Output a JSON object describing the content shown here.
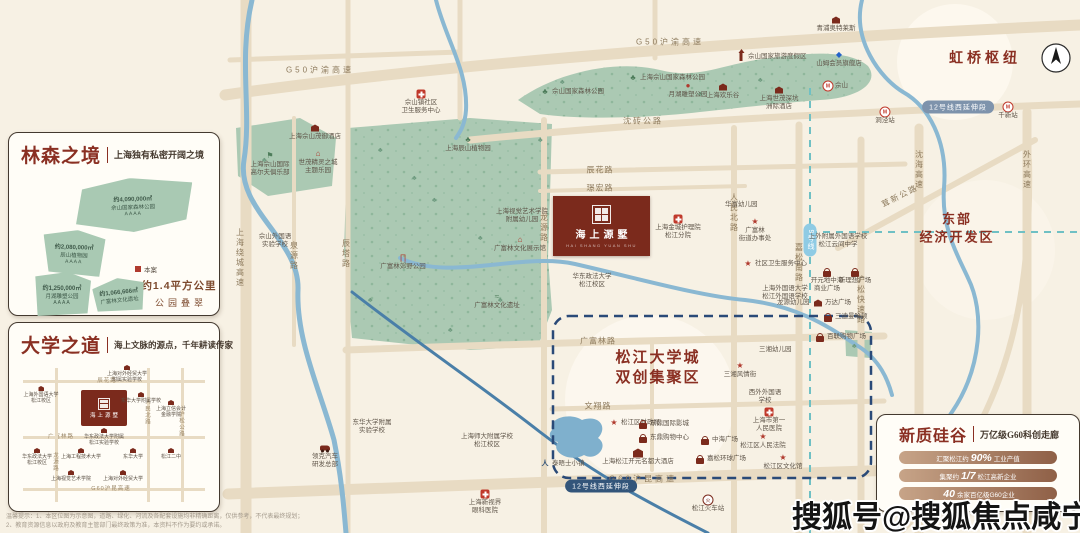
{
  "watermark": "搜狐号@搜狐焦点咸宁站",
  "disclaimer": {
    "line1": "温馨提示：1、本区位图为示意图，道路、绿化、河流及各配套设施均非精确距离，仅供参考，不代表最终规划；",
    "line2": "2、教育资源信息以政府及教育主管部门最终政策为准，本资料不作为要约或承诺。"
  },
  "project": {
    "name": "海上源墅",
    "name_en": "HAI SHANG YUAN SHU"
  },
  "colors": {
    "accent": "#8a2f22",
    "park_green": "#abc9b3",
    "river_blue": "#8ab8d2",
    "road_tan": "#e8dbc3",
    "navy_dash": "#2a4a78",
    "teal_dash": "#6fc0c4"
  },
  "cards": {
    "forest": {
      "title": "林森之境",
      "subtitle": "上海独有私密开阔之境",
      "patches": [
        {
          "x": 56,
          "y": 6,
          "w": 120,
          "h": 54,
          "rot": -2,
          "shape": 1,
          "lines": [
            "约4,090,000㎡",
            "佘山国家森林公园",
            "AAAA"
          ]
        },
        {
          "x": 26,
          "y": 58,
          "w": 62,
          "h": 46,
          "rot": 2,
          "shape": 2,
          "lines": [
            "约2,080,000㎡",
            "辰山植物园",
            "AAAA"
          ]
        },
        {
          "x": 16,
          "y": 100,
          "w": 58,
          "h": 44,
          "rot": 0,
          "shape": 3,
          "lines": [
            "约1,250,000㎡",
            "月湖雕塑公园",
            "AAAA"
          ]
        },
        {
          "x": 76,
          "y": 106,
          "w": 52,
          "h": 34,
          "rot": -6,
          "shape": 4,
          "lines": [
            "约1,066,666㎡",
            "广富林文化遗址"
          ]
        }
      ],
      "legend": "本案",
      "highlight": {
        "line1": "约1.4平方公里",
        "line2": "公园叠翠"
      }
    },
    "university": {
      "title": "大学之道",
      "subtitle": "海上文脉的源点，千年耕读传家",
      "minimap": {
        "roads": [
          {
            "o": "h",
            "pos": 16,
            "label": "辰花路",
            "lx": 88,
            "ly": 16
          },
          {
            "o": "h",
            "pos": 72,
            "label": "广富林路",
            "lx": 42,
            "ly": 72
          },
          {
            "o": "h",
            "pos": 124,
            "label": "G60沪昆高速",
            "lx": 92,
            "ly": 124
          },
          {
            "o": "v",
            "pos": 36,
            "label": "龙源路",
            "lx": 36,
            "ly": 98
          },
          {
            "o": "v",
            "pos": 128,
            "label": "人民北路",
            "lx": 128,
            "ly": 48
          },
          {
            "o": "v",
            "pos": 162,
            "label": "沪松公路",
            "lx": 162,
            "ly": 60
          }
        ],
        "logo_name": "海上源墅",
        "schools": [
          {
            "x": 22,
            "y": 22,
            "t": "上海外国语大学\n松江校区"
          },
          {
            "x": 108,
            "y": 1,
            "t": "上海对外经贸大学\n附属实验学校"
          },
          {
            "x": 122,
            "y": 28,
            "t": "东华大学附属学校"
          },
          {
            "x": 152,
            "y": 36,
            "t": "上海立信会计\n金融学院"
          },
          {
            "x": 152,
            "y": 84,
            "t": "松江二中"
          },
          {
            "x": 85,
            "y": 64,
            "t": "华东政法大学附属\n松江实验学校"
          },
          {
            "x": 18,
            "y": 84,
            "t": "华东政法大学\n松江校区"
          },
          {
            "x": 62,
            "y": 84,
            "t": "上海工程技术大学"
          },
          {
            "x": 114,
            "y": 84,
            "t": "东华大学"
          },
          {
            "x": 52,
            "y": 106,
            "t": "上海视觉艺术学院"
          },
          {
            "x": 104,
            "y": 106,
            "t": "上海对外经贸大学"
          }
        ]
      }
    },
    "silicon": {
      "title": "新质硅谷",
      "subtitle": "万亿级G60科创走廊",
      "bars": [
        {
          "pre": "汇聚松江约",
          "big": "90%",
          "suf": "工业产值"
        },
        {
          "pre": "集聚约",
          "big": "1/7",
          "suf": "松江高新企业"
        },
        {
          "pre": "",
          "big": "40",
          "suf": "余家百亿级G60企业"
        }
      ]
    }
  },
  "map": {
    "area_labels": [
      {
        "text": "虹桥枢纽",
        "x": 985,
        "y": 60,
        "size": 14,
        "ls": 4
      },
      {
        "text": "东部\n经济开发区",
        "x": 957,
        "y": 228,
        "size": 13,
        "ls": 2
      },
      {
        "text": "松江大学城\n双创集聚区",
        "x": 658,
        "y": 368,
        "size": 15,
        "ls": 2
      }
    ],
    "road_labels": [
      {
        "t": "G50沪渝高速",
        "x": 320,
        "y": 70,
        "ls": 3
      },
      {
        "t": "G50沪渝高速",
        "x": 670,
        "y": 42,
        "ls": 3
      },
      {
        "t": "沈砖公路",
        "x": 643,
        "y": 121,
        "ls": 2
      },
      {
        "t": "辰花路",
        "x": 600,
        "y": 170,
        "ls": 1
      },
      {
        "t": "璟宏路",
        "x": 600,
        "y": 188,
        "ls": 1
      },
      {
        "t": "广富林路",
        "x": 598,
        "y": 341,
        "ls": 1
      },
      {
        "t": "文翔路",
        "x": 598,
        "y": 406,
        "ls": 1
      },
      {
        "t": "G60沪昆高速",
        "x": 643,
        "y": 479,
        "ls": 3
      },
      {
        "t": "上海绕城高速",
        "x": 240,
        "y": 258,
        "v": 1
      },
      {
        "t": "泉源路",
        "x": 294,
        "y": 256,
        "v": 1
      },
      {
        "t": "辰塔路",
        "x": 346,
        "y": 254,
        "v": 1
      },
      {
        "t": "龙源路",
        "x": 544,
        "y": 228,
        "v": 1
      },
      {
        "t": "人民北路",
        "x": 734,
        "y": 213,
        "v": 1
      },
      {
        "t": "嘉松南路",
        "x": 799,
        "y": 263,
        "v": 1
      },
      {
        "t": "沪松快速路",
        "x": 861,
        "y": 300,
        "v": 1
      },
      {
        "t": "茸新公路",
        "x": 900,
        "y": 196,
        "angle": -27
      },
      {
        "t": "沈海高速",
        "x": 919,
        "y": 170,
        "v": 1
      },
      {
        "t": "外环高速",
        "x": 1027,
        "y": 170,
        "v": 1
      }
    ],
    "pills": [
      {
        "t": "12号线西延伸段",
        "x": 958,
        "y": 107,
        "bg": "#7e93ac"
      },
      {
        "t": "12号线西延伸段",
        "x": 601,
        "y": 486,
        "bg": "#33557a"
      },
      {
        "t": "9号线",
        "x": 810,
        "y": 240,
        "v": 1,
        "bg": "#8fcbe4"
      }
    ],
    "pois": [
      {
        "x": 741,
        "y": 57,
        "icon": "tower",
        "label": "佘山国家旅游度假区",
        "pos": "right"
      },
      {
        "x": 545,
        "y": 92,
        "icon": "tree",
        "label": "佘山国家森林公园",
        "pos": "right"
      },
      {
        "x": 633,
        "y": 78,
        "icon": "tree",
        "label": "上海佘山国家森林公园",
        "pos": "right"
      },
      {
        "x": 688,
        "y": 86,
        "icon": "dot",
        "label": "月湖雕塑公园",
        "pos": "below"
      },
      {
        "x": 723,
        "y": 87,
        "icon": "house",
        "label": "上海欢乐谷",
        "pos": "below"
      },
      {
        "x": 779,
        "y": 90,
        "icon": "house",
        "label": "上海世茂深坑\n洲际酒店",
        "pos": "below"
      },
      {
        "x": 421,
        "y": 94,
        "icon": "cross",
        "label": "佘山镇社区\n卫生服务中心",
        "pos": "below"
      },
      {
        "x": 315,
        "y": 128,
        "icon": "house",
        "label": "上海佘山茂御酒店",
        "pos": "below"
      },
      {
        "x": 318,
        "y": 154,
        "icon": "pav",
        "label": "世茂精灵之城\n主题乐园",
        "pos": "below"
      },
      {
        "x": 270,
        "y": 156,
        "icon": "golf",
        "label": "上海佘山国际\n高尔夫俱乐部",
        "pos": "below"
      },
      {
        "x": 275,
        "y": 228,
        "icon": "school",
        "label": "佘山外国语\n实验学校",
        "pos": "below"
      },
      {
        "x": 468,
        "y": 140,
        "icon": "tree",
        "label": "上海辰山植物园",
        "pos": "below"
      },
      {
        "x": 522,
        "y": 203,
        "icon": "school",
        "label": "上海视觉艺术学院\n附属幼儿园",
        "pos": "below"
      },
      {
        "x": 520,
        "y": 240,
        "icon": "pav",
        "label": "广富林文化展示馆",
        "pos": "below"
      },
      {
        "x": 403,
        "y": 258,
        "icon": "gate",
        "label": "广富林郊野公园",
        "pos": "below"
      },
      {
        "x": 497,
        "y": 297,
        "icon": "mound",
        "label": "广富林文化遗址",
        "pos": "below"
      },
      {
        "x": 592,
        "y": 268,
        "icon": "school",
        "label": "华东政法大学\n松江校区",
        "pos": "below"
      },
      {
        "x": 678,
        "y": 219,
        "icon": "cross",
        "label": "上海金城护理院\n松江分院",
        "pos": "below"
      },
      {
        "x": 718,
        "y": 205,
        "icon": "school",
        "label": "华富幼儿园",
        "pos": "right"
      },
      {
        "x": 755,
        "y": 222,
        "icon": "star",
        "label": "广富林\n街道办事处",
        "pos": "below"
      },
      {
        "x": 748,
        "y": 264,
        "icon": "star",
        "label": "社区卫生服务中心",
        "pos": "right"
      },
      {
        "x": 785,
        "y": 280,
        "icon": "school",
        "label": "上海外国语大学\n松江外国语学校",
        "pos": "below"
      },
      {
        "x": 770,
        "y": 303,
        "icon": "school",
        "label": "龙源幼儿园",
        "pos": "right"
      },
      {
        "x": 836,
        "y": 20,
        "icon": "house",
        "label": "青浦奥特莱斯",
        "pos": "below"
      },
      {
        "x": 839,
        "y": 55,
        "icon": "diamond",
        "label": "山姆会员旗舰店",
        "pos": "below"
      },
      {
        "x": 828,
        "y": 86,
        "icon": "metro",
        "label": "佘山",
        "pos": "right"
      },
      {
        "x": 838,
        "y": 228,
        "icon": "school",
        "label": "上外附属外国语学校\n松江云间中学",
        "pos": "below"
      },
      {
        "x": 827,
        "y": 272,
        "icon": "bag",
        "label": "开元地中海\n商业广场",
        "pos": "below"
      },
      {
        "x": 855,
        "y": 272,
        "icon": "bag",
        "label": "新理想广场",
        "pos": "below"
      },
      {
        "x": 818,
        "y": 303,
        "icon": "house",
        "label": "万达广场",
        "pos": "right"
      },
      {
        "x": 828,
        "y": 317,
        "icon": "bag",
        "label": "三迪曼哈顿",
        "pos": "right"
      },
      {
        "x": 820,
        "y": 337,
        "icon": "bag",
        "label": "百联购物广场",
        "pos": "right"
      },
      {
        "x": 752,
        "y": 350,
        "icon": "school",
        "label": "三湘幼儿园",
        "pos": "right"
      },
      {
        "x": 740,
        "y": 366,
        "icon": "star",
        "label": "三湘风情街",
        "pos": "below"
      },
      {
        "x": 765,
        "y": 384,
        "icon": "school",
        "label": "西外外国语\n学校",
        "pos": "below"
      },
      {
        "x": 769,
        "y": 412,
        "icon": "cross",
        "label": "上海市第一\n人民医院",
        "pos": "below"
      },
      {
        "x": 763,
        "y": 437,
        "icon": "star",
        "label": "松江区人民法院",
        "pos": "below"
      },
      {
        "x": 783,
        "y": 458,
        "icon": "star",
        "label": "松江区文化馆",
        "pos": "below"
      },
      {
        "x": 614,
        "y": 423,
        "icon": "star",
        "label": "松江区财政局",
        "pos": "right"
      },
      {
        "x": 643,
        "y": 424,
        "icon": "bag",
        "label": "东鼎国际影城",
        "pos": "right"
      },
      {
        "x": 643,
        "y": 438,
        "icon": "bag",
        "label": "东鼎购物中心",
        "pos": "right"
      },
      {
        "x": 705,
        "y": 440,
        "icon": "bag",
        "label": "中海广场",
        "pos": "right"
      },
      {
        "x": 638,
        "y": 453,
        "icon": "hotel",
        "label": "上海松江开元名都大酒店",
        "pos": "below"
      },
      {
        "x": 700,
        "y": 459,
        "icon": "bag",
        "label": "嘉松环球广场",
        "pos": "right"
      },
      {
        "x": 545,
        "y": 464,
        "icon": "walk",
        "label": "泰晤士小镇",
        "pos": "right"
      },
      {
        "x": 372,
        "y": 414,
        "icon": "school",
        "label": "东华大学附属\n实验学校",
        "pos": "below"
      },
      {
        "x": 325,
        "y": 448,
        "icon": "car",
        "label": "领克汽车\n研发总部",
        "pos": "below"
      },
      {
        "x": 485,
        "y": 494,
        "icon": "cross",
        "label": "上海新视界\n眼科医院",
        "pos": "below"
      },
      {
        "x": 487,
        "y": 428,
        "icon": "school",
        "label": "上海师大附属学校\n松江校区",
        "pos": "below"
      },
      {
        "x": 708,
        "y": 500,
        "icon": "train",
        "label": "松江火车站",
        "pos": "below"
      },
      {
        "x": 885,
        "y": 112,
        "icon": "metro",
        "label": "洞泾站",
        "pos": "below"
      },
      {
        "x": 1008,
        "y": 107,
        "icon": "metro",
        "label": "千新站",
        "pos": "below"
      }
    ]
  }
}
